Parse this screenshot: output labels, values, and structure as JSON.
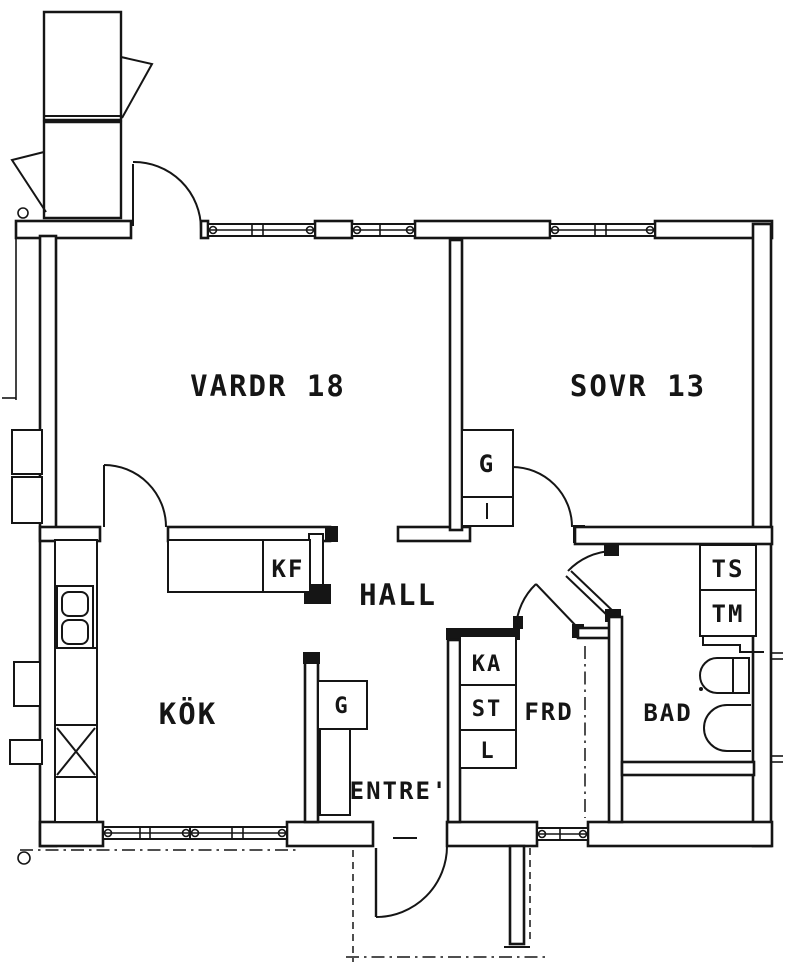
{
  "drawing": {
    "type": "apartment floor plan",
    "ink_color": "#151515",
    "paper_color": "#ffffff"
  },
  "rooms": {
    "living_room": {
      "label": "VARDR 18"
    },
    "bedroom": {
      "label": "SOVR 13"
    },
    "hall": {
      "label": "HALL"
    },
    "kitchen": {
      "label": "KÖK"
    },
    "entry": {
      "label": "ENTRE'"
    },
    "storage": {
      "label": "FRD"
    },
    "bathroom": {
      "label": "BAD"
    }
  },
  "fixtures": {
    "fridge_freezer": {
      "label": "KF"
    },
    "bedroom_wardrobe": {
      "label": "G"
    },
    "entry_wardrobe": {
      "label": "G"
    },
    "cabinet_ka": {
      "label": "KA"
    },
    "cabinet_st": {
      "label": "ST"
    },
    "cabinet_l": {
      "label": "L"
    },
    "drying_cabinet": {
      "label": "TS"
    },
    "washing_machine": {
      "label": "TM"
    }
  }
}
